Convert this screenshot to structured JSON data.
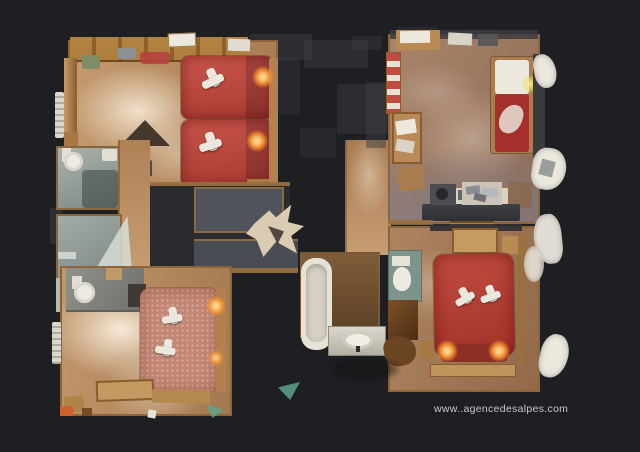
{
  "meta": {
    "canvas_width": 640,
    "canvas_height": 452
  },
  "watermark": {
    "text": "www..agencedesalpes.com",
    "color": "#d6d6d8"
  },
  "floorplan": {
    "view": "top-down 3D dollhouse scan of an apartment",
    "palette": {
      "background": "#1e1f23",
      "wood": "#b5875c",
      "wood-light": "#d3ae84",
      "wall-wood": "#9a6f3d",
      "wall-dark": "#8a6134",
      "bed-red": "#bf4138",
      "bed-red-deep": "#992f28",
      "bed-pink": "#c28775",
      "tile": "#9aa59f",
      "tile-dark": "#76827c",
      "panel-grey": "#50525a",
      "ghost-grey": "#3c3e44",
      "dark-zone": "#2a2b2f",
      "fixture-white": "#ece8de",
      "lamp-glow": "#ff9a35",
      "watermark-color": "#d6d6d8"
    },
    "rooms": [
      {
        "id": "bedroom-twin-top-left",
        "visible_items": [
          "red twin bed x2",
          "white folded towels x2",
          "lit bedside lamps",
          "wall shelves",
          "radiator"
        ]
      },
      {
        "id": "bathroom-upper-left",
        "visible_items": [
          "toilet",
          "washbasin"
        ]
      },
      {
        "id": "bathroom-lower-left",
        "visible_items": [
          "round washbasin",
          "mirror"
        ]
      },
      {
        "id": "bedroom-double-bottom-left",
        "visible_items": [
          "pink double bed",
          "white folded towels x2",
          "lit bedside lamp",
          "desk",
          "toilet nook"
        ]
      },
      {
        "id": "living-room-top-right",
        "visible_items": [
          "single bed with red cover",
          "table",
          "chair",
          "kitchen counter",
          "stove",
          "sink with dishes",
          "desk"
        ]
      },
      {
        "id": "bathroom-center",
        "visible_items": [
          "bathtub",
          "washbasin counter",
          "toilet",
          "closet"
        ]
      },
      {
        "id": "bedroom-double-bottom-right",
        "visible_items": [
          "red double bed",
          "white folded towels x2",
          "two lit bedside lamps",
          "bench"
        ]
      }
    ]
  }
}
